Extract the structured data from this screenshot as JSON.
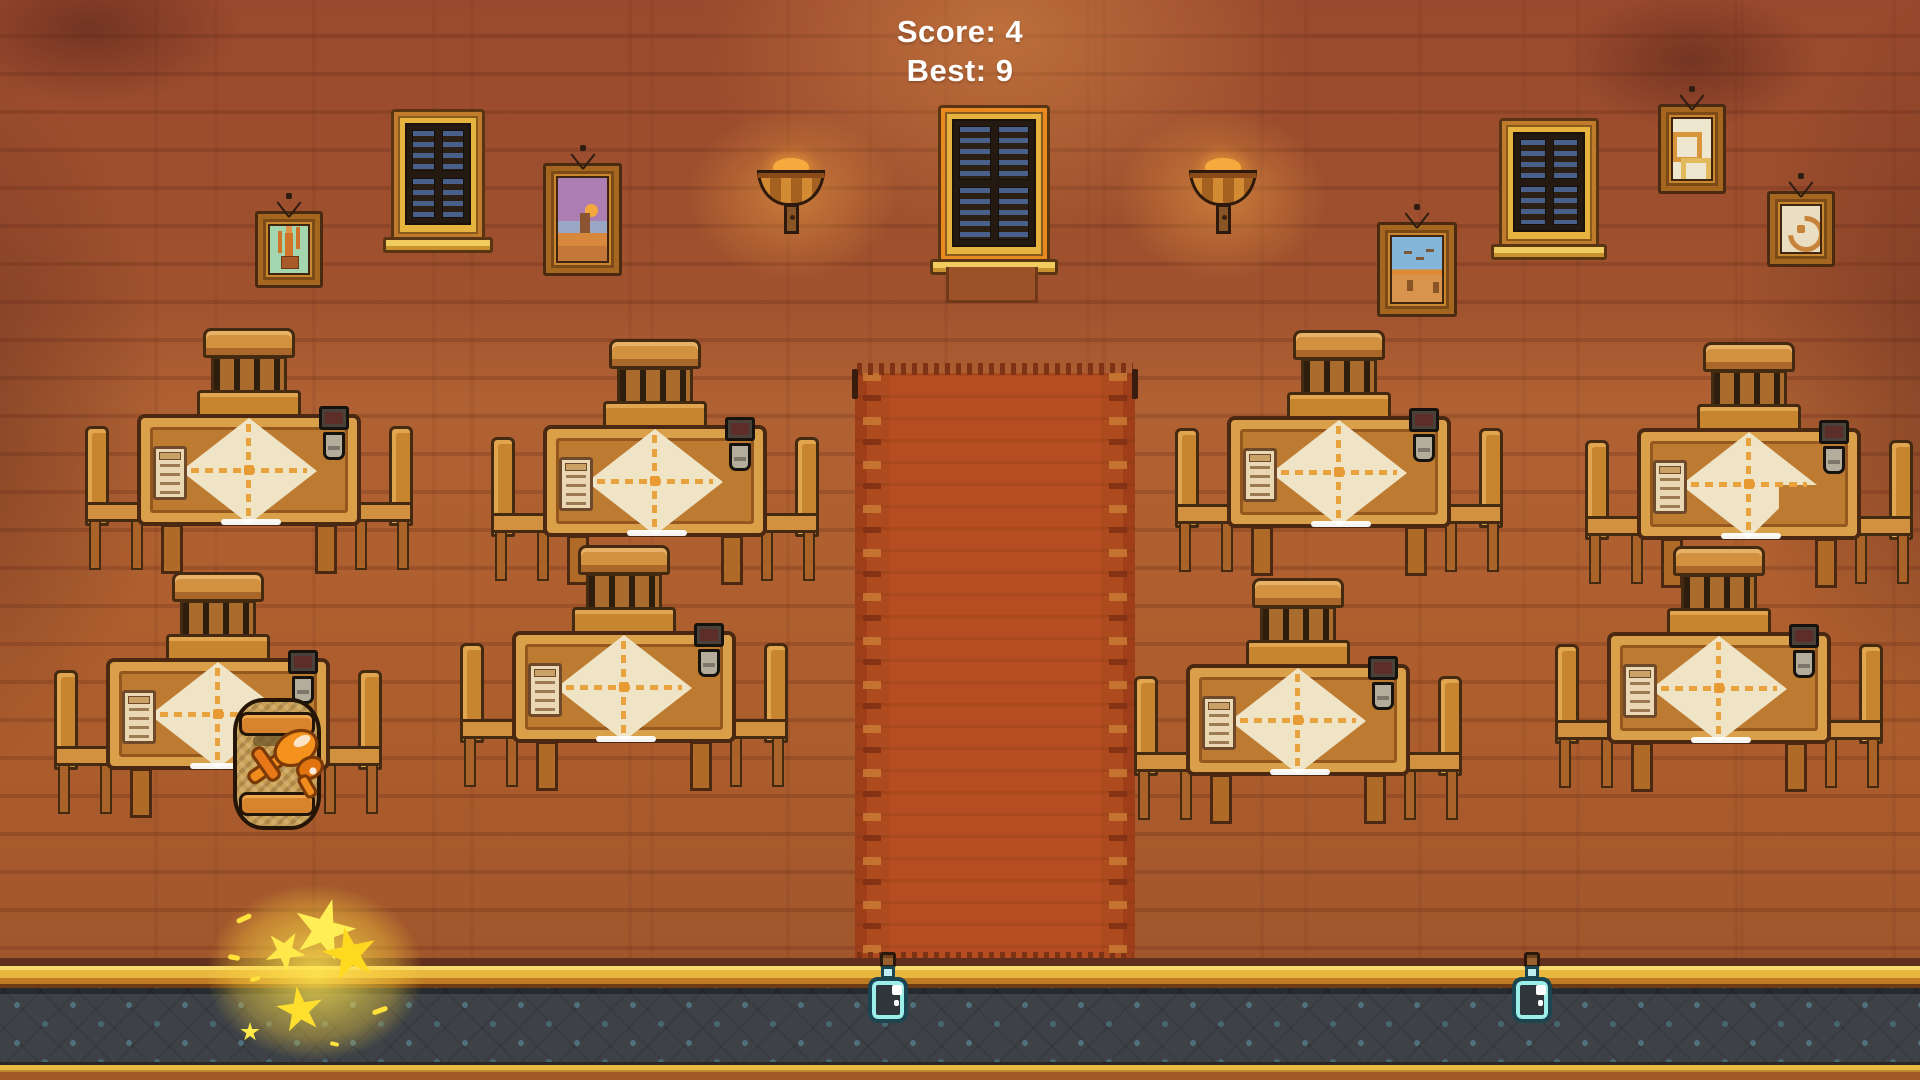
{
  "hud": {
    "score_label": "Score: 4",
    "best_label": "Best: 9",
    "score": 4,
    "best": 9
  },
  "scene": {
    "object_names": [
      "brick-wall",
      "red-carpet",
      "window",
      "wall-lamp",
      "painting",
      "dining-table-set",
      "chair",
      "table-lantern",
      "menu-card",
      "tablecloth",
      "barrel",
      "plane-sprite",
      "potion-bottle",
      "sparkle-burst",
      "tavern-floor"
    ],
    "counts": {
      "table_sets": 8,
      "windows": 3,
      "paintings": 5,
      "wall_lamps": 2,
      "potions": 2
    },
    "colors": {
      "wall": "#a9592c",
      "carpet": "#b54d20",
      "wood": "#c8852f",
      "tablecloth": "#f0e4c7",
      "floor": "#3e4247",
      "gold_trim": "#e9b640",
      "potion_glass": "#9ceee8",
      "sparkle": "#ffe23c",
      "hud_text": "#ffffff"
    }
  }
}
